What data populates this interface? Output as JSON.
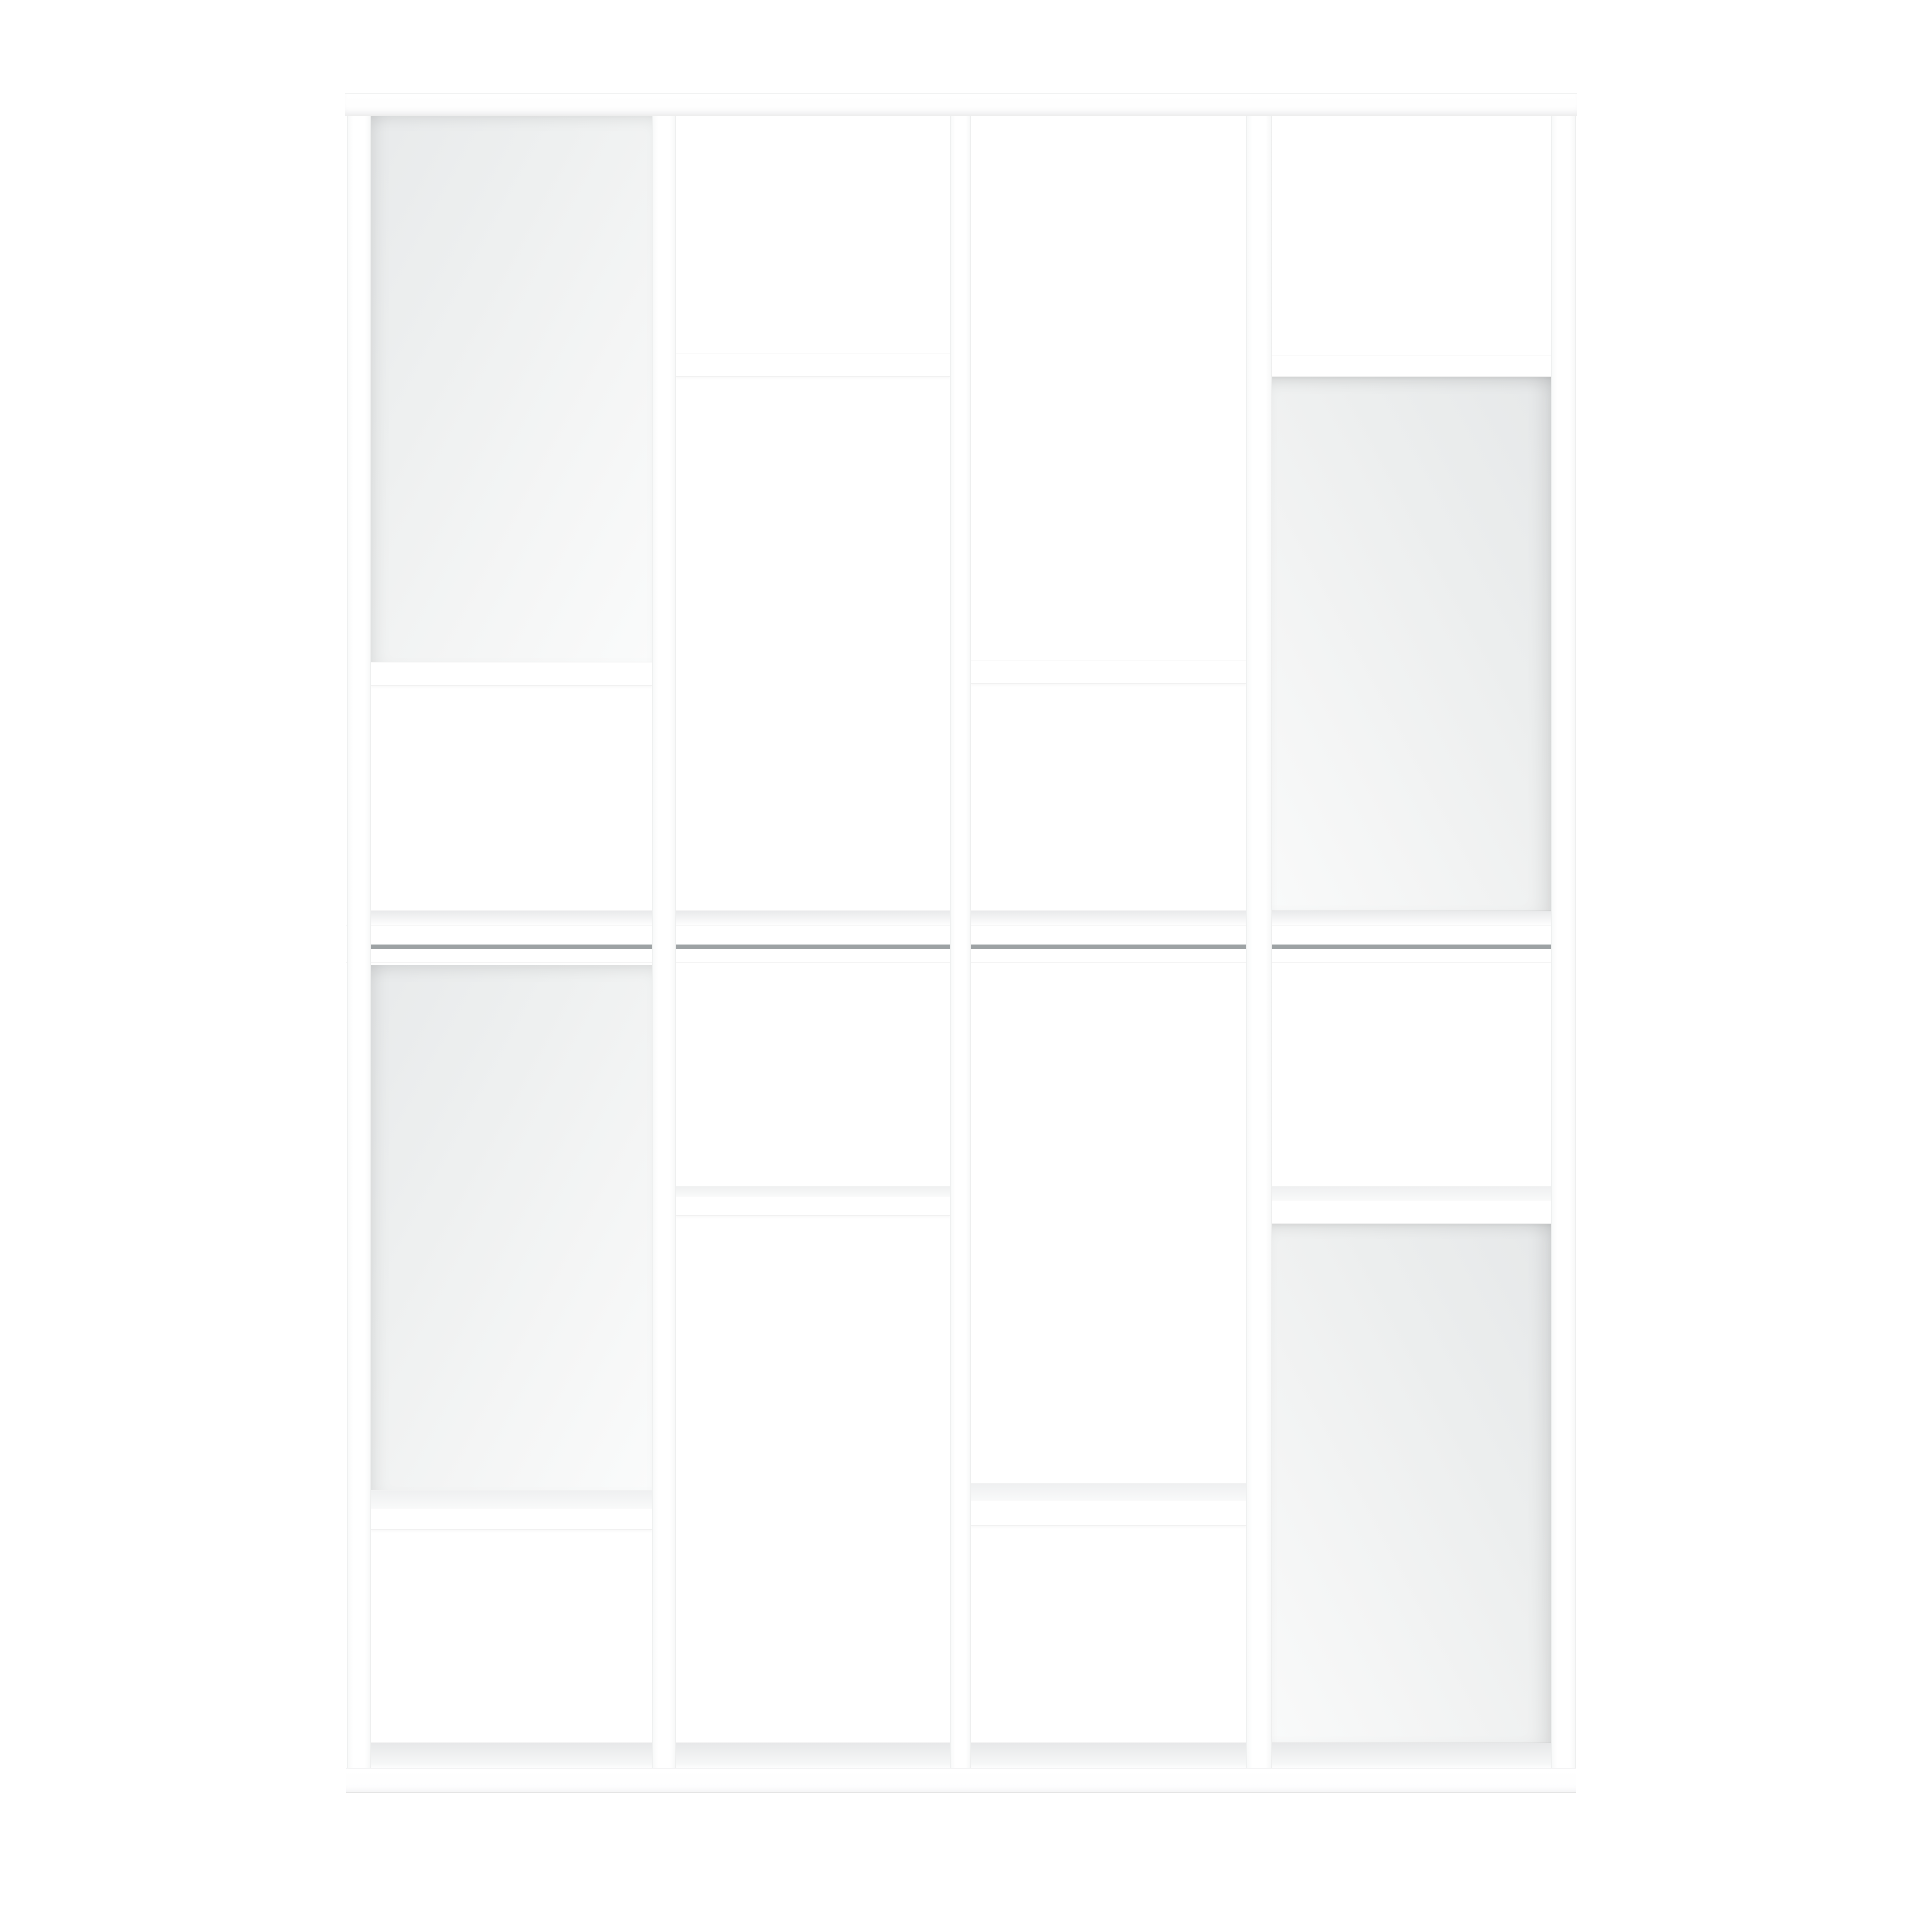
{
  "scene": {
    "description": "Front view product photo of a white geometric open bookcase / shelving room divider made of two stacked modules with four columns, staggered shelves and four light-grey recessed back panels, on a plain white background",
    "object": "bookcase",
    "background_color": "#ffffff",
    "furniture_color": "#ffffff",
    "back_panel_color": "#eceeee",
    "shadow_color": "#e7e8e9",
    "seam_color": "#9da2a4",
    "canvas": {
      "width": 1920,
      "height": 1920
    }
  },
  "bookcase": {
    "outer": {
      "x": 345,
      "y": 93,
      "w": 1232,
      "h": 1698
    },
    "top_board": {
      "x": 345,
      "y": 93,
      "w": 1232,
      "h": 21
    },
    "mid_band": {
      "x": 346,
      "y": 925,
      "w": 1230,
      "h": 38
    },
    "bottom_board": {
      "x": 346,
      "y": 1768,
      "w": 1230,
      "h": 23
    },
    "verticals": [
      {
        "name": "left-upright",
        "x": 347,
        "y": 114,
        "w": 24,
        "h": 1654
      },
      {
        "name": "divider-1",
        "x": 652,
        "y": 114,
        "w": 24,
        "h": 1654
      },
      {
        "name": "divider-2",
        "x": 950,
        "y": 114,
        "w": 21,
        "h": 1654
      },
      {
        "name": "divider-3",
        "x": 1246,
        "y": 114,
        "w": 26,
        "h": 1654
      },
      {
        "name": "right-upright",
        "x": 1551,
        "y": 114,
        "w": 25,
        "h": 1654
      }
    ],
    "columns": [
      {
        "name": "column-1",
        "x": 371,
        "w": 281
      },
      {
        "name": "column-2",
        "x": 676,
        "w": 274
      },
      {
        "name": "column-3",
        "x": 971,
        "w": 275
      },
      {
        "name": "column-4",
        "x": 1272,
        "w": 279
      }
    ],
    "back_panels": [
      {
        "name": "back-panel-top-left",
        "x": 371,
        "y": 114,
        "w": 281,
        "h": 548,
        "shade": "left"
      },
      {
        "name": "back-panel-top-right",
        "x": 1272,
        "y": 377,
        "w": 279,
        "h": 535,
        "shade": "right"
      },
      {
        "name": "back-panel-bottom-left",
        "x": 371,
        "y": 965,
        "w": 281,
        "h": 526,
        "shade": "left"
      },
      {
        "name": "back-panel-bottom-right",
        "x": 1272,
        "y": 1222,
        "w": 279,
        "h": 521,
        "shade": "right"
      }
    ],
    "shelves": [
      {
        "name": "shelf-top-col1",
        "x": 371,
        "y": 662,
        "w": 281,
        "wedge": 0,
        "front": 24
      },
      {
        "name": "shelf-top-col2",
        "x": 676,
        "y": 353,
        "w": 274,
        "wedge": 0,
        "front": 24
      },
      {
        "name": "shelf-top-col3",
        "x": 971,
        "y": 660,
        "w": 275,
        "wedge": 0,
        "front": 24
      },
      {
        "name": "shelf-top-col4",
        "x": 1272,
        "y": 355,
        "w": 279,
        "wedge": 0,
        "front": 22
      },
      {
        "name": "shelf-bottom-col1",
        "x": 371,
        "y": 1490,
        "w": 281,
        "wedge": 18,
        "front": 22
      },
      {
        "name": "shelf-bottom-col2",
        "x": 676,
        "y": 1186,
        "w": 274,
        "wedge": 10,
        "front": 20
      },
      {
        "name": "shelf-bottom-col3",
        "x": 971,
        "y": 1483,
        "w": 275,
        "wedge": 17,
        "front": 26
      },
      {
        "name": "shelf-bottom-col4",
        "x": 1272,
        "y": 1186,
        "w": 279,
        "wedge": 14,
        "front": 24
      }
    ],
    "mid_wedge": {
      "y": 910,
      "h": 15
    },
    "bottom_wedge": {
      "y": 1742,
      "h": 26
    },
    "seam": {
      "y": 944,
      "h": 4
    }
  }
}
